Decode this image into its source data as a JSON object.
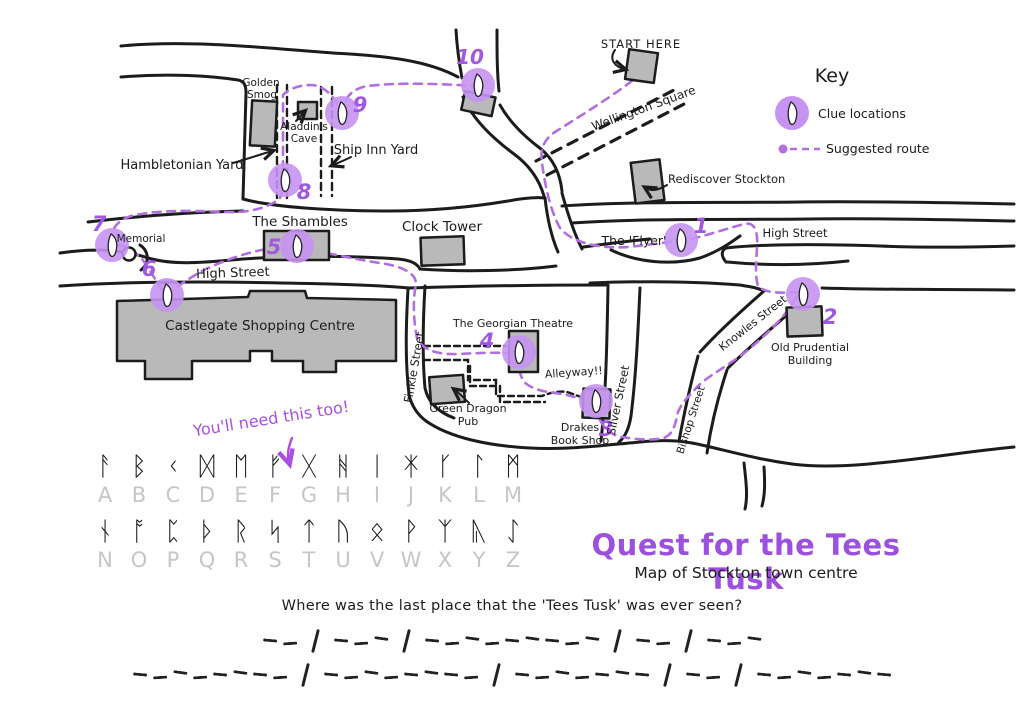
{
  "title": "Quest for the Tees Tusk",
  "subtitle": "Map of Stockton town centre",
  "question": "Where was the last place that the 'Tees Tusk' was ever seen?",
  "hint_text": "You'll need this too!",
  "start_label": "START HERE",
  "key": {
    "title": "Key",
    "clue_label": "Clue locations",
    "route_label": "Suggested route"
  },
  "colors": {
    "accent_purple": "#9d4fe0",
    "route_purple": "#b26fe3",
    "clue_circle": "#c693f2",
    "building_grey": "#b9b9b9",
    "ink": "#1c1c1c",
    "faded_letter_grey": "#c6c6c6"
  },
  "map_labels": {
    "wellington_square": "Wellington Square",
    "rediscover_stockton": "Rediscover Stockton",
    "golden_smog": [
      "Golden",
      "Smog"
    ],
    "aladdins_cave": [
      "Aladdin's",
      "Cave"
    ],
    "ship_inn_yard": "Ship Inn Yard",
    "hambletonian_yard": "Hambletonian Yard",
    "the_shambles": "The Shambles",
    "clock_tower": "Clock Tower",
    "memorial": "Memorial",
    "high_street_left": "High Street",
    "high_street_right": "High Street",
    "castlegate": "Castlegate Shopping Centre",
    "georgian_theatre": "The Georgian Theatre",
    "green_dragon": [
      "Green Dragon",
      "Pub"
    ],
    "finkle_street": "Finkle Street",
    "alleyway": "Alleyway!!",
    "drakes": [
      "Drakes",
      "Book Shop"
    ],
    "silver_street": "Silver Street",
    "bishop_street": "Bishop Street",
    "knowles_street": "Knowles Street",
    "the_flyer": "The 'Flyer'",
    "old_prudential": [
      "Old Prudential",
      "Building"
    ]
  },
  "clue_numbers": [
    "1",
    "2",
    "3",
    "4",
    "5",
    "6",
    "7",
    "8",
    "9",
    "10"
  ],
  "runes": [
    {
      "letter": "A",
      "rune": "ᚨ"
    },
    {
      "letter": "B",
      "rune": "ᛒ"
    },
    {
      "letter": "C",
      "rune": "ᚲ"
    },
    {
      "letter": "D",
      "rune": "ᛞ"
    },
    {
      "letter": "E",
      "rune": "ᛖ"
    },
    {
      "letter": "F",
      "rune": "ᚠ"
    },
    {
      "letter": "G",
      "rune": "ᚷ"
    },
    {
      "letter": "H",
      "rune": "ᚻ"
    },
    {
      "letter": "I",
      "rune": "ᛁ"
    },
    {
      "letter": "J",
      "rune": "ᛡ"
    },
    {
      "letter": "K",
      "rune": "ᚴ"
    },
    {
      "letter": "L",
      "rune": "ᛚ"
    },
    {
      "letter": "M",
      "rune": "ᛗ"
    },
    {
      "letter": "N",
      "rune": "ᚾ"
    },
    {
      "letter": "O",
      "rune": "ᚩ"
    },
    {
      "letter": "P",
      "rune": "ᛈ"
    },
    {
      "letter": "Q",
      "rune": "ᚦ"
    },
    {
      "letter": "R",
      "rune": "ᚱ"
    },
    {
      "letter": "S",
      "rune": "ᛋ"
    },
    {
      "letter": "T",
      "rune": "ᛏ"
    },
    {
      "letter": "U",
      "rune": "ᚢ"
    },
    {
      "letter": "V",
      "rune": "ᛟ"
    },
    {
      "letter": "W",
      "rune": "ᚹ"
    },
    {
      "letter": "X",
      "rune": "ᛉ"
    },
    {
      "letter": "Y",
      "rune": "ᚣ"
    },
    {
      "letter": "Z",
      "rune": "ᛇ"
    }
  ],
  "answer_blanks": [
    [
      2,
      3,
      9,
      2,
      3
    ],
    [
      8,
      8,
      7,
      2,
      7
    ]
  ]
}
